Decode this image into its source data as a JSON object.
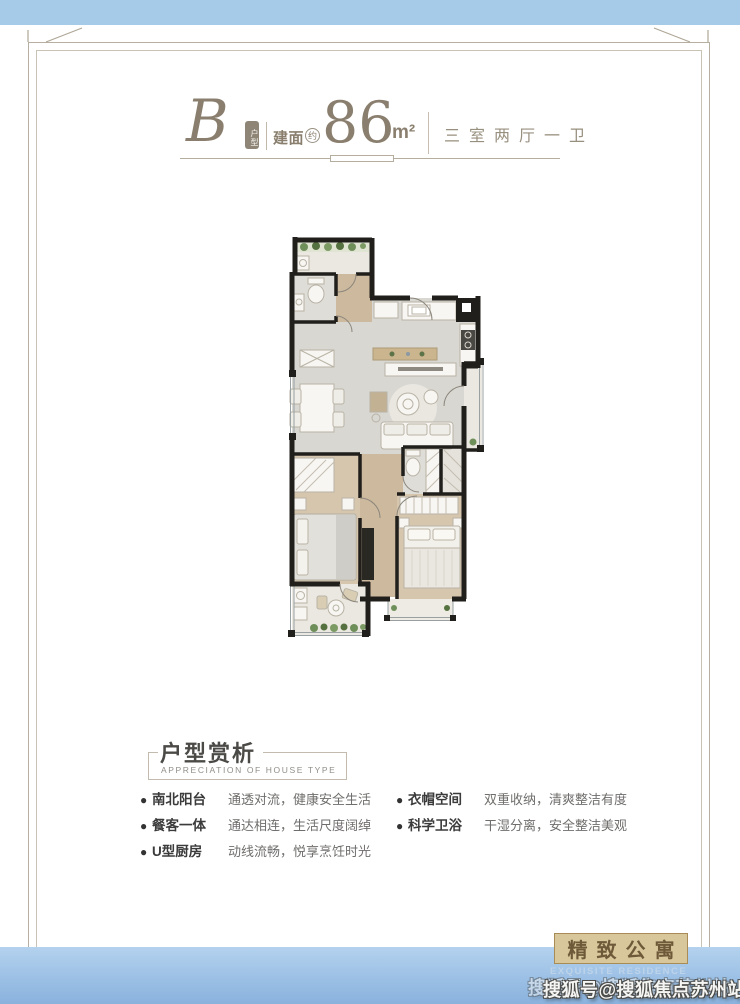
{
  "header": {
    "unit_letter": "B",
    "unit_tag": "户型",
    "area_label": "建面",
    "area_approx": "约",
    "area_value": "86",
    "area_unit": "m²",
    "layout": "三室两厅一卫"
  },
  "analysis": {
    "title": "户型赏析",
    "subtitle": "APPRECIATION OF HOUSE TYPE",
    "features_left": [
      {
        "label": "南北阳台",
        "desc": "通透对流，健康安全生活"
      },
      {
        "label": "餐客一体",
        "desc": "通达相连，生活尺度阔绰"
      },
      {
        "label": "U型厨房",
        "desc": "动线流畅，悦享烹饪时光"
      }
    ],
    "features_right": [
      {
        "label": "衣帽空间",
        "desc": "双重收纳，清爽整洁有度"
      },
      {
        "label": "科学卫浴",
        "desc": "干湿分离，安全整洁美观"
      }
    ]
  },
  "stamp": {
    "title": "精致公寓",
    "subtitle": "EXQUISITE RESIDENCE"
  },
  "watermark": {
    "text": "搜狐号@搜狐焦点苏州站"
  },
  "colors": {
    "band_blue_top": "#a6cbe9",
    "band_blue_bottom": "#8ab2dd",
    "accent_taupe": "#8a7f6e",
    "frame_line": "#b6afa2",
    "wall_black": "#211f1c",
    "floor_wood": "#cdb99e",
    "floor_gray": "#d8d7d1",
    "stamp_bg": "#d9c79c",
    "stamp_text": "#6e5a39"
  }
}
